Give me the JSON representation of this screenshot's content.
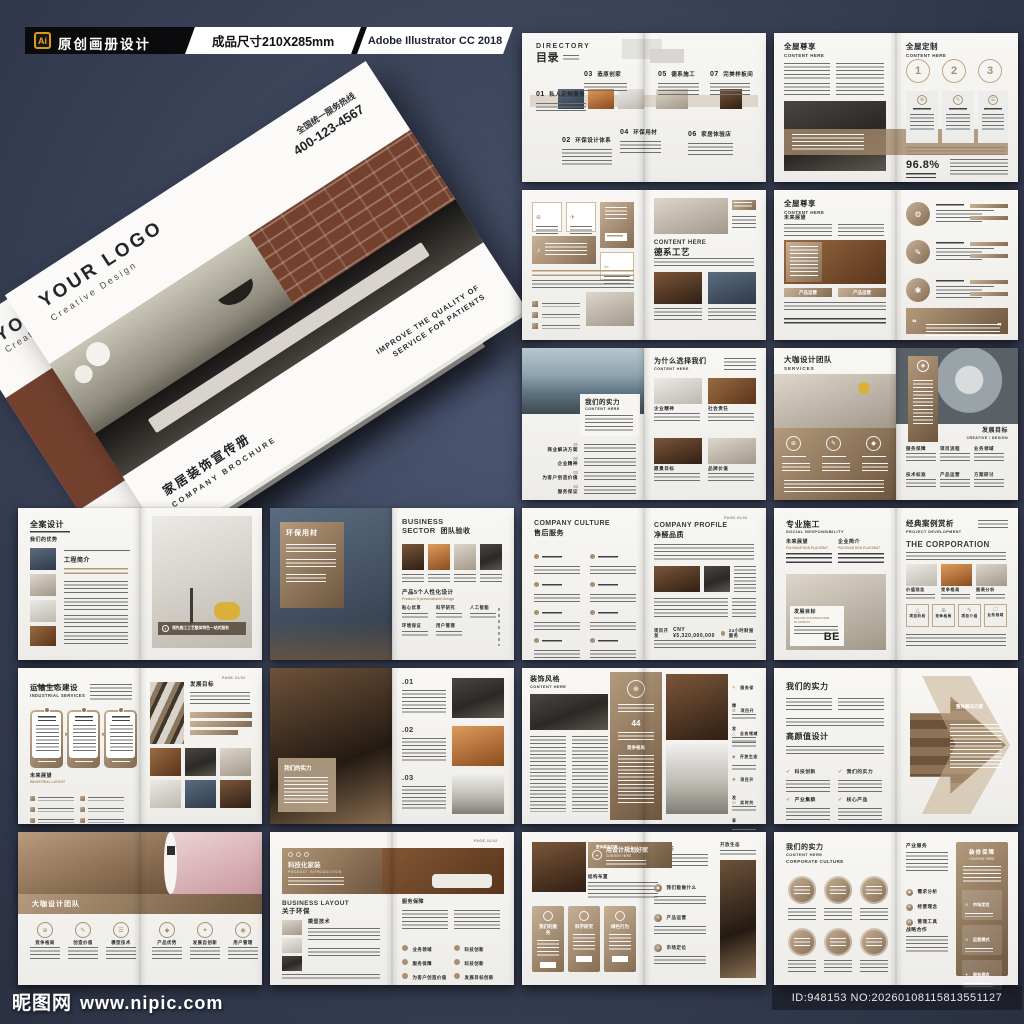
{
  "colors": {
    "bg": "#3c445a",
    "accent": "#a8906e",
    "paper": "#f6f5f2",
    "header_black": "#0b0b0e",
    "ai_orange": "#e9a61e"
  },
  "header": {
    "ai_badge": "Ai",
    "title": "原创画册设计",
    "size": "成品尺寸210X285mm",
    "software": "Adobe Illustrator CC 2018"
  },
  "watermark": {
    "site": "昵图网",
    "url": "www.nipic.com",
    "id": "ID:948153 NO:20260108115813551127"
  },
  "mockup": {
    "logo": "YOUR LOGO",
    "logo_sub": "Creative Design",
    "hotline_label": "全国统一服务热线",
    "hotline": "400-123-4567",
    "title_cn": "家居装饰宣传册",
    "title_en": "COMPANY BROCHURE",
    "tagline1": "IMPROVE THE QUALITY OF",
    "tagline2": "SERVICE FOR PATIENTS"
  },
  "icons": {
    "compass": "⊕",
    "plane": "✈",
    "audio": "♪",
    "scissors": "✂",
    "pen": "✎",
    "gear": "⚙",
    "spark": "✱",
    "person": "◉",
    "check": "✔",
    "quote_open": "❝",
    "quote_close": "❞",
    "star": "✦",
    "doc": "☰",
    "triangle": "△",
    "square": "□",
    "diamond": "◆",
    "arrow": "►",
    "pin": "⊙",
    "ring": "◎",
    "dot": "●"
  },
  "spreads": {
    "s1": {
      "en": "DIRECTORY",
      "cn": "目录",
      "items": [
        {
          "num": "01",
          "label": "私人定制服务"
        },
        {
          "num": "02",
          "label": "环保设计体系"
        },
        {
          "num": "03",
          "label": "造原创家"
        },
        {
          "num": "04",
          "label": "环保用材"
        },
        {
          "num": "05",
          "label": "德系施工"
        },
        {
          "num": "06",
          "label": "家居体验店"
        },
        {
          "num": "07",
          "label": "完美样板间"
        }
      ]
    },
    "s2": {
      "left_cn": "全屋尊享",
      "left_en": "CONTENT HERE",
      "right_cn": "全屋定制",
      "right_en": "CONTENT HERE",
      "steps": [
        "1",
        "2",
        "3"
      ],
      "stat": "96.8%"
    },
    "s3": {
      "right_en": "CONTENT HERE",
      "right_cn": "德系工艺"
    },
    "s4": {
      "left_cn": "全屋尊享",
      "left_en": "CONTENT HERE",
      "tag": "未来展望",
      "bar1": "产品运营",
      "bar2": "产品运营"
    },
    "s5": {
      "left_cn": "我们的实力",
      "left_en": "CONTENT HERE",
      "list": [
        {
          "num": "01",
          "label": "商业解决方案"
        },
        {
          "num": "02",
          "label": "企业精神"
        },
        {
          "num": "03",
          "label": "为客户创造价值"
        },
        {
          "num": "04",
          "label": "服务保证"
        }
      ],
      "right_cn": "为什么选择我们",
      "right_en": "CONTENT HERE",
      "caps": [
        "企业精神",
        "社会责任",
        "愿景目标",
        "品牌价值"
      ]
    },
    "s6": {
      "left_cn": "大咖设计团队",
      "left_en": "SERVICES",
      "right_cn": "发展目标",
      "right_en": "CREATIVE / DESIGN",
      "cols": [
        "服务保障",
        "项目流程",
        "业务领域",
        "技术标准",
        "产品运营",
        "方案研讨"
      ]
    },
    "s7": {
      "cn": "全案设计",
      "tag": "我们的优势",
      "section": "工程简介",
      "caption": "领先施工工艺整体特色一站式服务"
    },
    "s8": {
      "panel": "环保用材",
      "en1": "BUSINESS",
      "en2": "SECTOR",
      "cn": "团队验收",
      "sec": "产品5个人性化设计",
      "sec_en": "Product 5 personalized design",
      "items": [
        "贴心优享",
        "科学研究",
        "人工智能",
        "环境保证",
        "用户管理"
      ]
    },
    "s9": {
      "left_en": "COMPANY CULTURE",
      "left_cn": "售后服务",
      "right_en": "COMPANY PROFILE",
      "right_cn": "净醛品质",
      "page": "PAGE-01/02",
      "k1": "项目开发",
      "v1": "CNY ¥5,320,000,000",
      "k2": "24小时财报服务"
    },
    "s10": {
      "cn": "专业施工",
      "en": "SOCIAL RESPONSIBILITY",
      "c1": "未来展望",
      "c1s": "PULVINAR NON PLACERAT",
      "c2": "企业简介",
      "c2s": "PULVINAR NON PLACERAT",
      "card": "发展目标",
      "card_s": "DOLOR, PULVINAR NON PLACERAT",
      "be": "BE",
      "r_cn": "经典案例赏析",
      "r_en": "PROJECT DEVELOPMENT",
      "corp": "THE CORPORATION",
      "caps": [
        "价值观念",
        "竞争格局",
        "图表分析"
      ],
      "boxes": [
        "项目阶段",
        "竞争格局",
        "项目介绍",
        "业务领域"
      ]
    },
    "s11": {
      "cn": "运输生态建设",
      "en": "INDUSTRIAL SERVICES",
      "tag": "未来展望",
      "tag_en": "INDUSTRIAL LAYOUT",
      "goal": "发展目标",
      "page": "PAGE-01/02"
    },
    "s12": {
      "panel": "我们的实力",
      "nums": [
        ".01",
        ".02",
        ".03"
      ]
    },
    "s13": {
      "cn": "装饰风格",
      "en": "CONTENT HERE",
      "num": "44",
      "mid": "竞争格局",
      "items": [
        "服务保障",
        "项目开发",
        "业务领域",
        "开放生态",
        "项目开发",
        "实时共享"
      ]
    },
    "s14": {
      "cn": "我们的实力",
      "cn2": "高颜值设计",
      "checks": [
        "科技创新",
        "我们的实力",
        "产业集群",
        "核心产品"
      ],
      "arrow": "整体解决方案"
    },
    "s15": {
      "band": "大咖设计团队",
      "items": [
        "竞争格局",
        "创造价值",
        "模型技术",
        "产品优势",
        "发展自创新",
        "用户管理"
      ]
    },
    "s16": {
      "banner_cn": "科技化家装",
      "banner_en": "PRODUCT INTRODUCTION",
      "en": "BUSINESS LAYOUT",
      "cn": "关于环保",
      "tag1": "模型技术",
      "tag2": "服务保障",
      "page": "PAGE-01/02",
      "items": [
        "业务领域",
        "科技创新",
        "服务保障",
        "科技创新",
        "为客户创造价值",
        "发展目标创新"
      ]
    },
    "s17": {
      "band": "整体解决方案",
      "cn": "用设计规划好家",
      "en": "CONTENT HERE",
      "tag1": "结构布置",
      "cards": [
        "我们的服务",
        "科学研究",
        "绿色行为"
      ],
      "tag2": "社会责任",
      "items": [
        "我们能做什么",
        "产品运营",
        "市场定位"
      ],
      "tag3": "开放生态"
    },
    "s18": {
      "cn": "我们的实力",
      "en1": "CONTENT HERE",
      "en2": "CORPORATE CULTURE",
      "tag1": "产业服务",
      "items": [
        "需求分析",
        "经营理念",
        "管理工具"
      ],
      "tag2": "战略合作",
      "panel_cn": "装修保障",
      "panel_en": "CONTENT HERE",
      "panel_items": [
        "市场定位",
        "运营模式",
        "服务理念"
      ]
    }
  }
}
